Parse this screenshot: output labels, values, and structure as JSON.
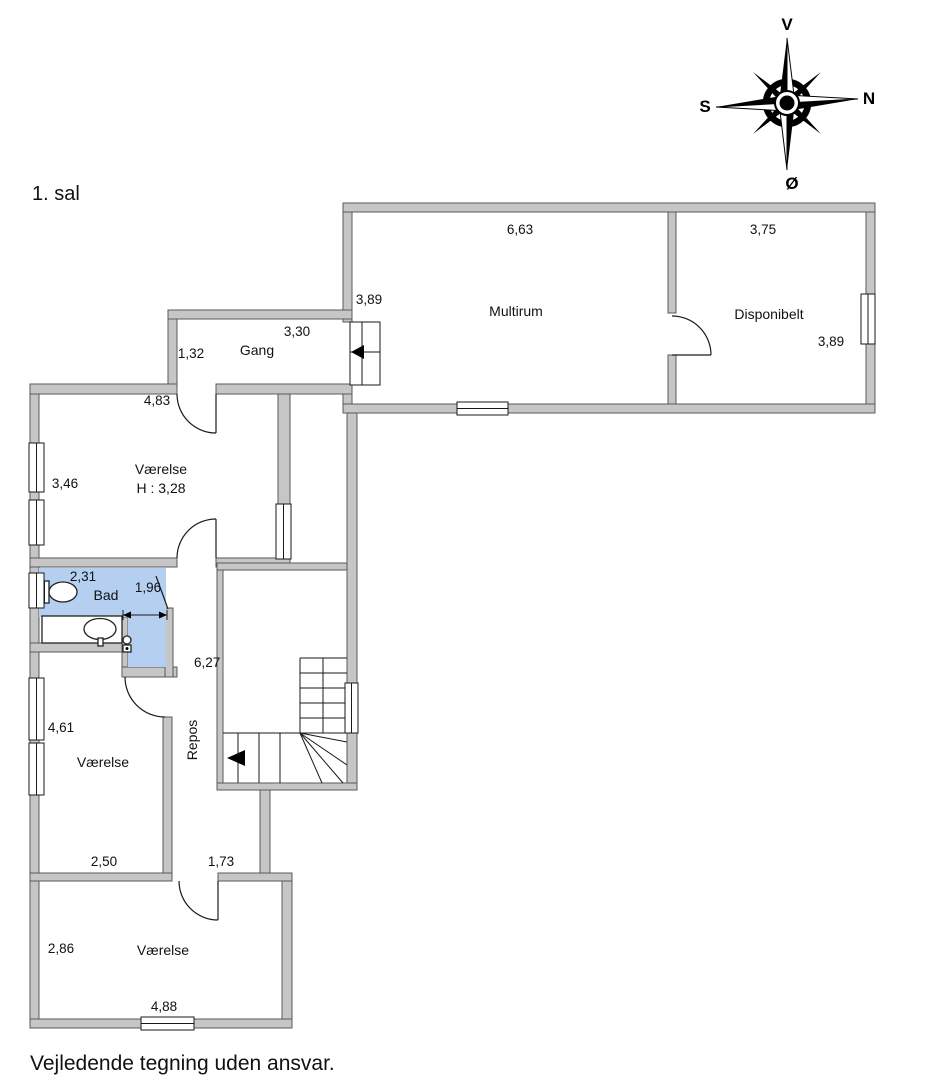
{
  "title": "1. sal",
  "disclaimer": "Vejledende tegning uden ansvar.",
  "compass": {
    "top": "V",
    "right": "N",
    "left": "S",
    "bottom": "Ø"
  },
  "rooms": {
    "multirum": {
      "name": "Multirum",
      "dim_top": "6,63",
      "dim_left": "3,89"
    },
    "disponibelt": {
      "name": "Disponibelt",
      "dim_top": "3,75",
      "dim_right": "3,89"
    },
    "gang": {
      "name": "Gang",
      "dim_top": "3,30",
      "dim_left": "1,32"
    },
    "vaerelse_nw": {
      "name": "Værelse",
      "ceiling_height": "H : 3,28",
      "dim_top": "4,83",
      "dim_left": "3,46"
    },
    "bad": {
      "name": "Bad",
      "dim_top": "2,31",
      "dim_door": "1,96"
    },
    "repos": {
      "name": "Repos",
      "dim_right": "6,27"
    },
    "vaerelse_w": {
      "name": "Værelse",
      "dim_left": "4,61",
      "dim_bottom": "2,50"
    },
    "hall_bottom": {
      "dim_bottom": "1,73"
    },
    "vaerelse_s": {
      "name": "Værelse",
      "dim_left": "2,86",
      "dim_bottom": "4,88"
    }
  },
  "icons": {
    "compass_rose": "8-point star with ring, letters V/N/S/Ø",
    "toilet_icon": "tank rectangle + oval bowl",
    "sink_icon": "oval basin with tap in counter",
    "shower_valve_icon": "small valve circle with handle",
    "stair_direction_arrow": "solid left-pointing triangle"
  },
  "colors": {
    "wall_fill": "#c6c6c6",
    "wall_edge": "#5a5a5a",
    "wet_room": "#b4cff0"
  }
}
